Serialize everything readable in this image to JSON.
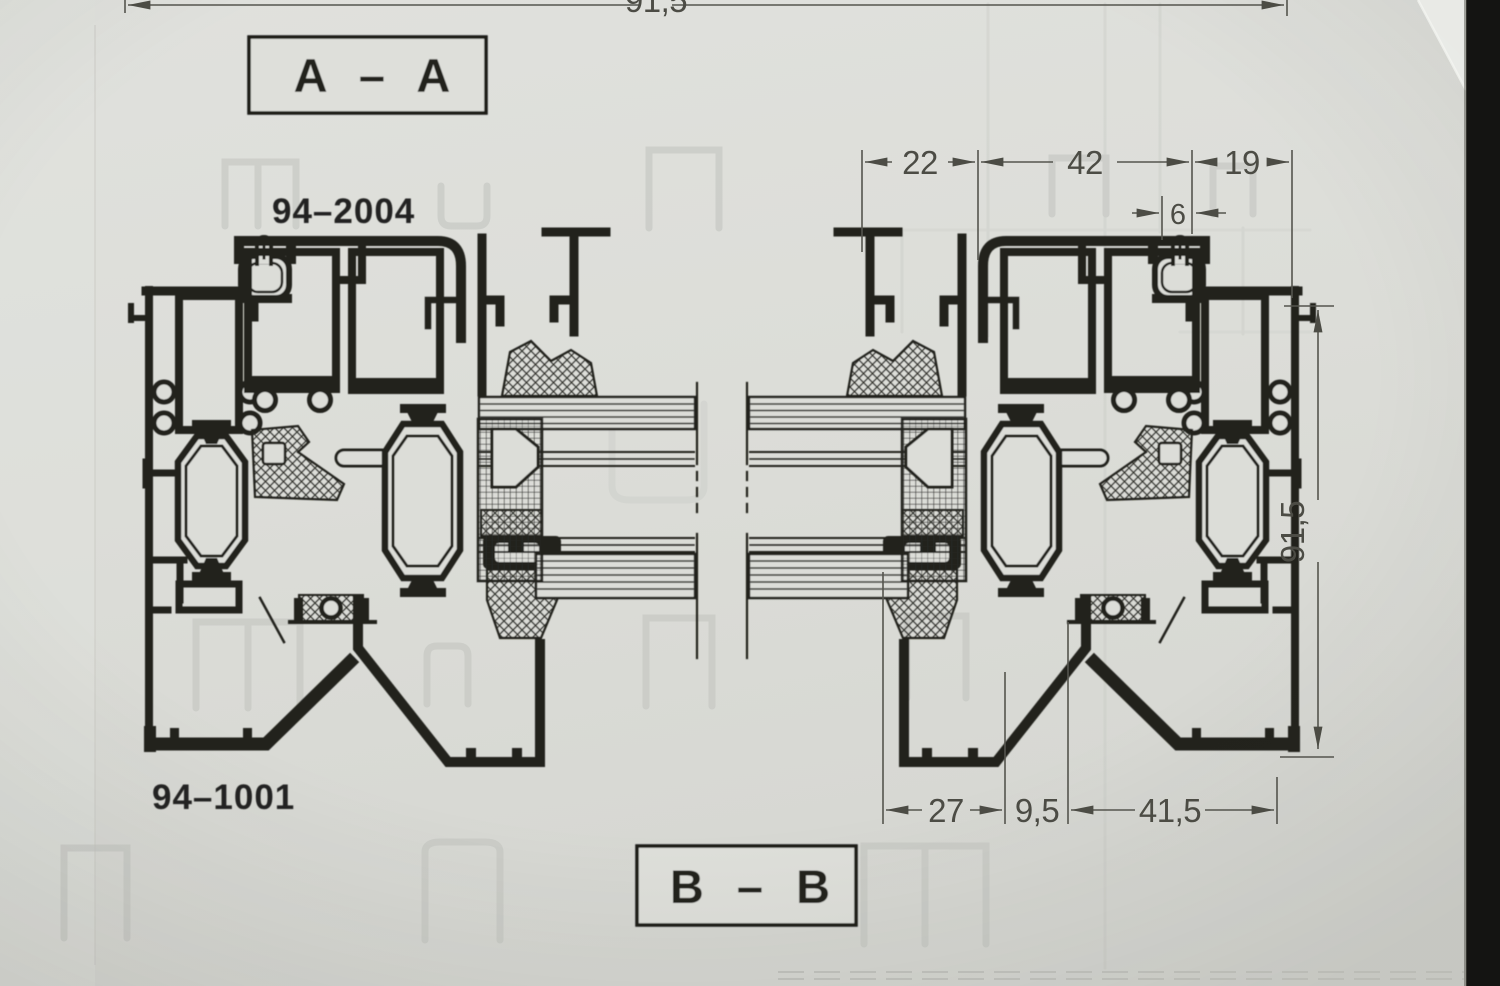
{
  "document": {
    "kind": "scanned technical drawing, window profile cross sections"
  },
  "labels": {
    "section_top": "A – A",
    "section_bottom": "B – B",
    "part_upper": "94–2004",
    "part_lower": "94–1001"
  },
  "dimensions": {
    "top_edge": "91,5",
    "top_chain": [
      "22",
      "42",
      "19"
    ],
    "detail": "6",
    "right_vertical": "91,5",
    "bottom_chain": [
      "27",
      "9,5",
      "41,5"
    ]
  },
  "colors": {
    "paper": "#dcddd8",
    "ink": "#22231f",
    "dim_ink": "#4c4c45",
    "ghost": "#c3c6c1",
    "film_edge": "#141412"
  }
}
